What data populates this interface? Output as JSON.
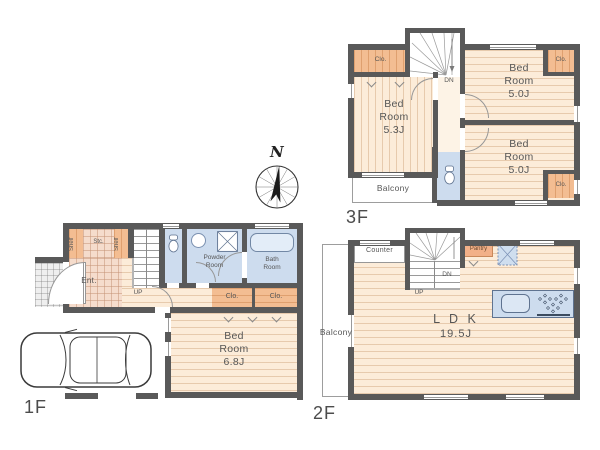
{
  "title": "3-story house floor plan",
  "compass": {
    "north_label": "N"
  },
  "floor3": {
    "floor_label": "3F",
    "closet_top_left": "Clo.",
    "closet_top_right": "Clo.",
    "closet_bottom_right": "Clo.",
    "bedroom_left": "Bed\nRoom\n5.3J",
    "bedroom_top_right": "Bed\nRoom\n5.0J",
    "bedroom_bottom_right": "Bed\nRoom\n5.0J",
    "stairs_dn": "DN",
    "balcony": "Balcony"
  },
  "floor2": {
    "floor_label": "2F",
    "counter": "Counter",
    "pantry": "Pantry",
    "stairs_dn": "DN",
    "stairs_up": "UP",
    "ldk_name": "L D K",
    "ldk_size": "19.5J",
    "balcony": "Balcony"
  },
  "floor1": {
    "floor_label": "1F",
    "shelf_left": "Shelf",
    "shelf_right": "Shelf",
    "storage": "Stc.",
    "entrance": "Ent.",
    "stairs_up": "UP",
    "powder_room": "Powder\nRoom",
    "bath_room": "Bath\nRoom",
    "closet_a": "Clo.",
    "closet_b": "Clo.",
    "bedroom": "Bed\nRoom\n6.8J"
  },
  "colors": {
    "wall": "#595959",
    "wood_floor": "#fcecd9",
    "closet": "#f3bd92",
    "wet_area": "#cddcee",
    "entrance_tile": "#f5dccc",
    "text": "#565656"
  }
}
